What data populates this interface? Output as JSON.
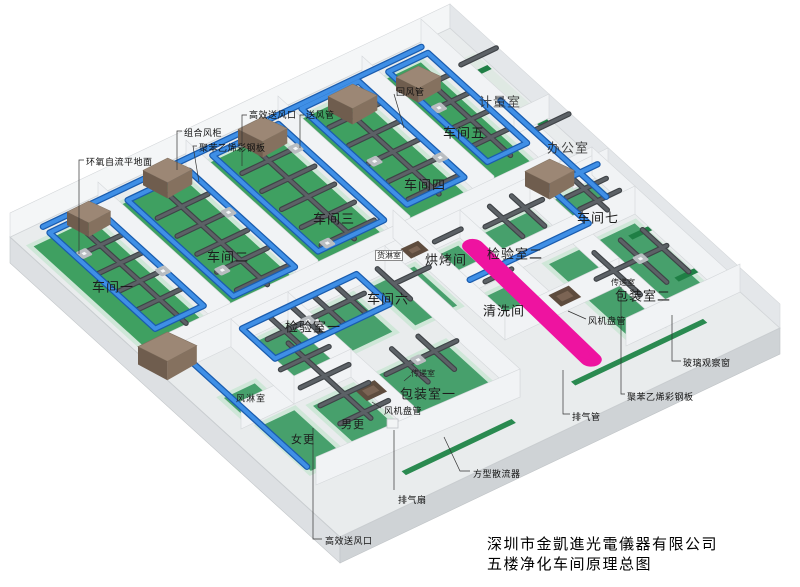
{
  "caption": {
    "company": "深圳市金凱進光電儀器有限公司",
    "drawing_title": "五楼净化车间原理总图"
  },
  "rooms": {
    "workshop1": "车间一",
    "workshop2": "车间二",
    "workshop3": "车间三",
    "workshop4": "车间四",
    "workshop5": "车间五",
    "workshop6": "车间六",
    "workshop7": "车间七",
    "inspection1": "检验室一",
    "inspection2": "检验室二",
    "baking_room": "烘烤间",
    "cleaning_room": "清洗间",
    "packing1": "包装室一",
    "packing2": "包装室二",
    "women_change": "女更",
    "men_change": "男更",
    "air_shower": "风淋室",
    "cargo_shower": "货淋室",
    "pass_room_right": "传递室",
    "pass_room_mid": "传递室",
    "metering_room": "计量室",
    "office": "办公室"
  },
  "annotations": {
    "combined_ahu": "组合风柜",
    "steel_panel_left": "聚苯乙烯彩钢板",
    "steel_panel_right": "聚苯乙烯彩钢板",
    "epoxy_floor": "环氧自流平地面",
    "hepa_outlet_top": "高效送风口",
    "hepa_outlet_bottom": "高效送风口",
    "supply_duct": "送风管",
    "return_duct": "回风管",
    "fan_coil_right": "风机盘管",
    "fan_coil_mid": "风机盘管",
    "glass_window": "玻璃观察窗",
    "exhaust_pipe": "排气管",
    "exhaust_fan": "排气扇",
    "square_diffuser": "方型散流器"
  },
  "legend_colors": {
    "floor_green": "#43a065",
    "supply_duct_blue": "#3f8fe6",
    "exhaust_duct_gray": "#5c6166",
    "ahu_brown": "#9c8775",
    "exhaust_pink": "#ee13a0",
    "slab_gray": "#d9dcde"
  }
}
